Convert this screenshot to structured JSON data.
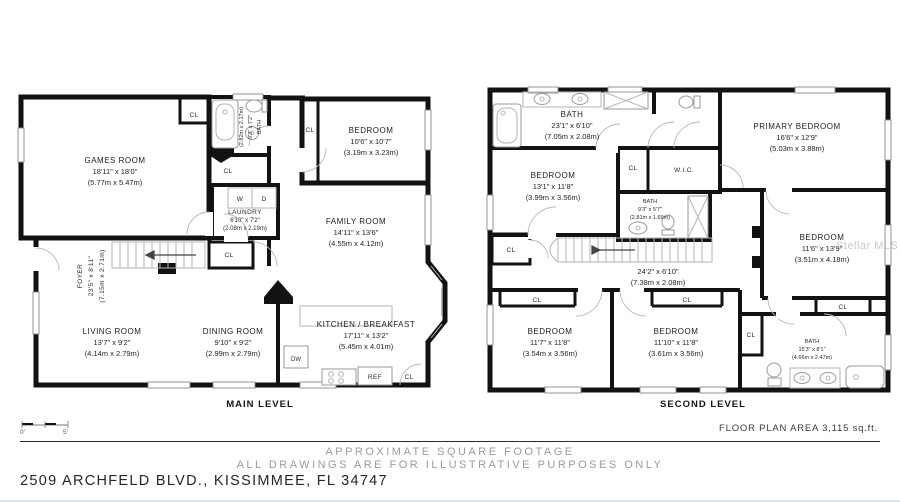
{
  "labels": {
    "closet": "CL",
    "washer": "W",
    "dryer": "D",
    "dishwasher": "DW",
    "fridge": "REF",
    "wic": "W.I.C."
  },
  "main_level": {
    "title": "MAIN LEVEL",
    "rooms": {
      "games_room": {
        "name": "GAMES ROOM",
        "imperial": "18'11\" x 18'0\"",
        "metric": "(5.77m x 5.47m)"
      },
      "bath": {
        "name": "BATH",
        "imperial": "9'3\" x 7'2\"",
        "metric": "(2.82m x 2.17m)"
      },
      "bedroom": {
        "name": "BEDROOM",
        "imperial": "10'6\" x 10'7\"",
        "metric": "(3.19m x 3.23m)"
      },
      "laundry": {
        "name": "LAUNDRY",
        "imperial": "6'10\" x 7'2\"",
        "metric": "(2.08m x 2.19m)"
      },
      "family_room": {
        "name": "FAMILY ROOM",
        "imperial": "14'11\" x 13'6\"",
        "metric": "(4.55m x 4.12m)"
      },
      "foyer": {
        "name": "FOYER",
        "imperial": "23'5\" x 8'11\"",
        "metric": "(7.15m x 2.71m)"
      },
      "living_room": {
        "name": "LIVING ROOM",
        "imperial": "13'7\" x 9'2\"",
        "metric": "(4.14m x 2.79m)"
      },
      "dining_room": {
        "name": "DINING ROOM",
        "imperial": "9'10\" x 9'2\"",
        "metric": "(2.99m x 2.79m)"
      },
      "kitchen": {
        "name": "KITCHEN / BREAKFAST",
        "imperial": "17'11\" x 13'2\"",
        "metric": "(5.45m x 4.01m)"
      }
    }
  },
  "second_level": {
    "title": "SECOND LEVEL",
    "rooms": {
      "bath_main": {
        "name": "BATH",
        "imperial": "23'1\" x 6'10\"",
        "metric": "(7.05m x 2.08m)"
      },
      "bedroom_upper_left": {
        "name": "BEDROOM",
        "imperial": "13'1\" x 11'8\"",
        "metric": "(3.99m x 3.56m)"
      },
      "bath_middle": {
        "name": "BATH",
        "imperial": "9'3\" x 5'7\"",
        "metric": "(2.81m x 1.69m)"
      },
      "primary_bedroom": {
        "name": "PRIMARY BEDROOM",
        "imperial": "16'6\" x 12'9\"",
        "metric": "(5.03m x 3.88m)"
      },
      "bedroom_right": {
        "name": "BEDROOM",
        "imperial": "11'6\" x 13'9\"",
        "metric": "(3.51m x 4.18m)"
      },
      "hall": {
        "imperial": "24'2\" x 6'10\"",
        "metric": "(7.38m x 2.08m)"
      },
      "bedroom_lower_left": {
        "name": "BEDROOM",
        "imperial": "11'7\" x 11'8\"",
        "metric": "(3.54m x 3.56m)"
      },
      "bedroom_lower_middle": {
        "name": "BEDROOM",
        "imperial": "11'10\" x 11'8\"",
        "metric": "(3.61m x 3.56m)"
      },
      "bath_lower_right": {
        "name": "BATH",
        "imperial": "15'3\" x 8'1\"",
        "metric": "(4.66m x 2.47m)"
      }
    }
  },
  "footer": {
    "floor_area": "FLOOR PLAN AREA 3,115 sq.ft.",
    "disclaimer_line1": "APPROXIMATE SQUARE FOOTAGE",
    "disclaimer_line2": "ALL DRAWINGS ARE FOR ILLUSTRATIVE PURPOSES ONLY",
    "address": "2509 ARCHFELD BLVD., KISSIMMEE, FL 34747",
    "scale_start": "0'",
    "scale_end": "5'"
  },
  "watermark": "Stellar MLS"
}
